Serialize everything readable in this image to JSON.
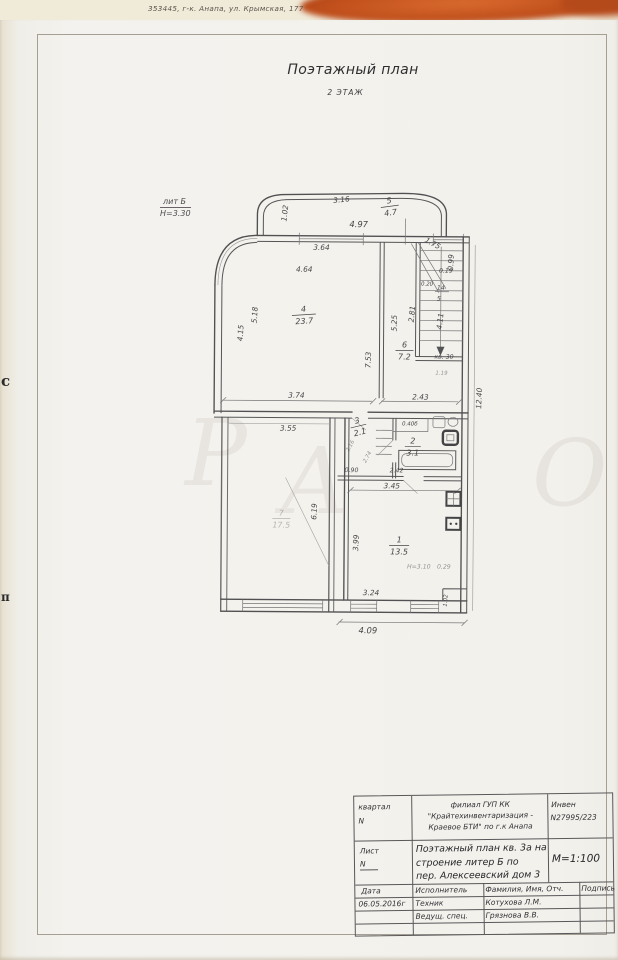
{
  "scan": {
    "address_line": "353445, г-к. Анапа, ул. Крымская, 177",
    "edge_mark_top": "с",
    "edge_mark_bottom": "п"
  },
  "page": {
    "title": "Поэтажный план",
    "subtitle": "2 ЭТАЖ",
    "liter": "лит Б",
    "height": "Н=3.30",
    "watermark": [
      "Р",
      "А",
      "О"
    ]
  },
  "plan": {
    "labels": [
      "3.16",
      "1.02",
      "4.97",
      "3.64",
      "4.64",
      "1.75",
      "0.99",
      "0.19",
      "0.20",
      "14",
      "5",
      "5.18",
      "4.15",
      "5.25",
      "2.81",
      "4.11",
      "7.53",
      "кв. 30",
      "1.19",
      "12.40",
      "3.74",
      "2.43",
      "3.55",
      "0.40б",
      "2.16",
      "2.74",
      "0.90",
      "2.42",
      "3.45",
      "6.19",
      "3.99",
      "Н=3.10",
      "0.29",
      "3.24",
      "4.09",
      "1.02"
    ],
    "rooms": [
      {
        "num": "5",
        "area": "4.7"
      },
      {
        "num": "4",
        "area": "23.7"
      },
      {
        "num": "6",
        "area": "7.2"
      },
      {
        "num": "3",
        "area": "2.1"
      },
      {
        "num": "2",
        "area": "3.1"
      },
      {
        "num": "1",
        "area": "13.5"
      },
      {
        "num": "7",
        "area": "17.5"
      }
    ]
  },
  "stamp": {
    "block_label": "квартал",
    "block_n": "N",
    "org_line1": "филиал ГУП КК",
    "org_line2": "\"Крайтехинвентаризация -",
    "org_line3": "Краевое БТИ\" по г.к Анапа",
    "inv_label": "Инвен",
    "inv_number": "N27995/223",
    "sheet_label": "Лист",
    "sheet_n": "N",
    "doc_title_line1": "Поэтажный план кв. 3а на",
    "doc_title_line2": "строение литер  Б по",
    "doc_title_line3": "пер. Алексеевский дом 3",
    "scale": "М=1:100",
    "col_date": "Дата",
    "col_executor": "Исполнитель",
    "col_name": "Фамилия, Имя, Отч.",
    "col_sign": "Подпись",
    "date_value": "06.05.2016г",
    "row1_role": "Техник",
    "row1_name": "Котухова Л.М.",
    "row2_role": "Ведущ. спец.",
    "row2_name": "Грязнова В.В."
  }
}
